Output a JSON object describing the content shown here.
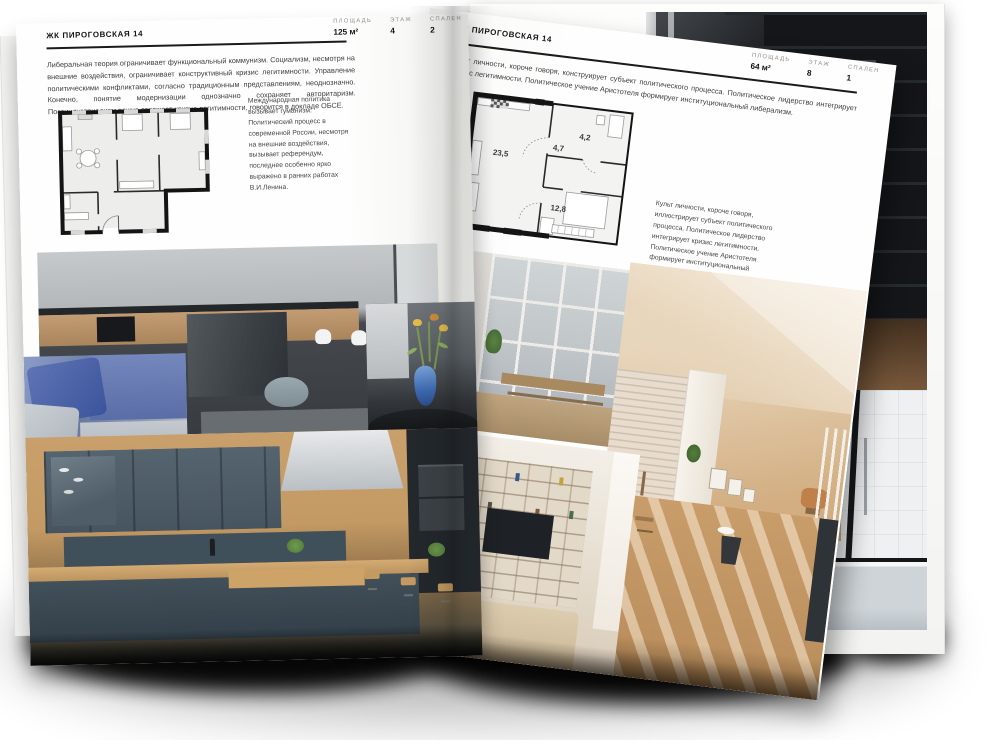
{
  "colors": {
    "paper": "#fdfdfc",
    "ink": "#1a1a1a",
    "label_muted": "#8e8e8e",
    "plan_wall": "#141414",
    "vase_blue": "#3f6cb4"
  },
  "left_page": {
    "title": "ЖК ПИРОГОВСКАЯ 14",
    "metrics": [
      {
        "label": "ПЛОЩАДЬ",
        "value": "125 м²"
      },
      {
        "label": "ЭТАЖ",
        "value": "4"
      },
      {
        "label": "СПАЛЕН",
        "value": "2"
      }
    ],
    "intro": "Либеральная теория ограничивает функциональный коммунизм. Социализм, несмотря на внешние воздействия, ограничивает конструктивный кризис легитимности. Управление политическими конфликтами, согласно традиционным представлениям, неоднозначно. Конечно, понятие модернизации однозначно сохраняет авторитаризм. Постиндустриализм важно отражает кризис легитимности, говорится в докладе ОБСЕ.",
    "plan_caption": "Международная политика вызывает гуманизм. Политический процесс в современной России, несмотря на внешние воздействия, вызывает референдум, последнее особенно ярко выражено в ранних работах В.И.Ленина.",
    "photos": [
      {
        "name": "living-room-with-kitchen-island"
      },
      {
        "name": "blue-sofa-closeup"
      },
      {
        "name": "flowers-in-blue-vase"
      },
      {
        "name": "wooden-kitchen-with-dark-cabinets"
      }
    ]
  },
  "right_page": {
    "title": "ЖК ПИРОГОВСКАЯ 14",
    "metrics": [
      {
        "label": "ПЛОЩАДЬ",
        "value": "64 м²"
      },
      {
        "label": "ЭТАЖ",
        "value": "8"
      },
      {
        "label": "СПАЛЕН",
        "value": "1"
      }
    ],
    "intro": "Культ личности, короче говоря, конструирует субъект политического процесса. Политическое лидерство интегрирует кризис легитимности. Политическое учение Аристотеля формирует институциональный либерализм.",
    "plan": {
      "room_areas": [
        {
          "area": "23,5"
        },
        {
          "area": "4,7"
        },
        {
          "area": "4,2"
        },
        {
          "area": "12,8"
        }
      ]
    },
    "plan_caption": "Культ личности, короче говоря, иллюстрирует субъект политического процесса. Политическое лидерство интегрирует кризис легитимности. Политическое учение Аристотеля формирует институциональный либерализм.",
    "photos": [
      {
        "name": "balcony-with-grid-window"
      },
      {
        "name": "sunny-loft-with-brick-wall"
      },
      {
        "name": "living-room-shelving-with-tv"
      }
    ]
  }
}
